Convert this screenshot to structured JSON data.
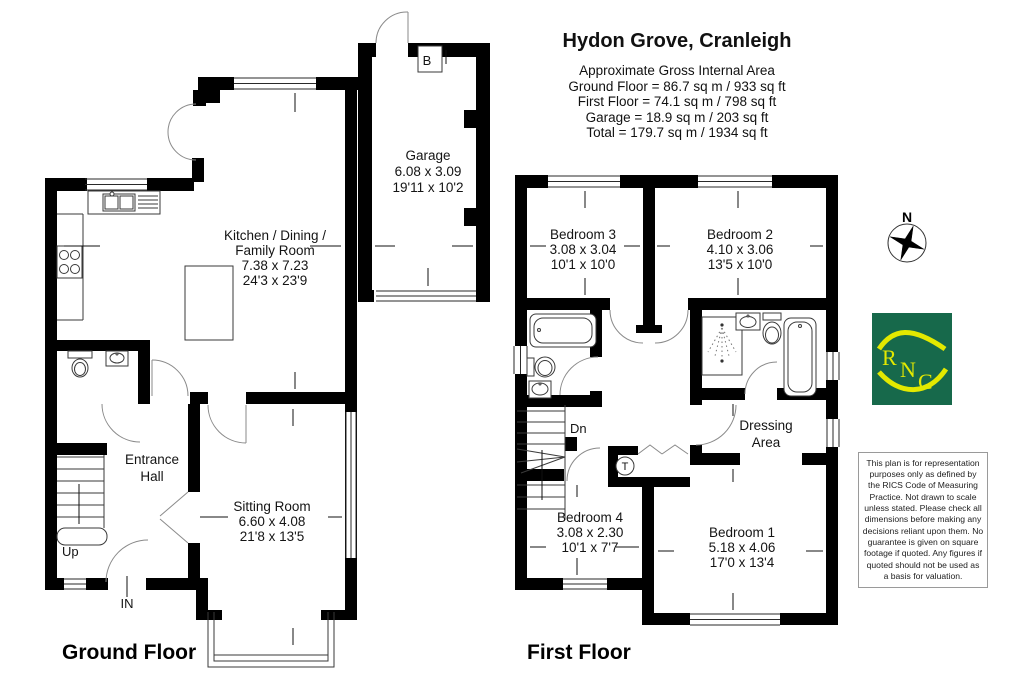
{
  "title_block": {
    "title": "Hydon Grove, Cranleigh",
    "area_lines": "Approximate Gross Internal Area\nGround Floor = 86.7 sq m / 933 sq ft\nFirst Floor = 74.1 sq m / 798 sq ft\nGarage = 18.9 sq m / 203 sq ft\nTotal = 179.7 sq m / 1934 sq ft"
  },
  "floors": {
    "ground": "Ground Floor",
    "first": "First Floor"
  },
  "rooms": {
    "kitchen": {
      "l1": "Kitchen / Dining /",
      "l2": "Family Room",
      "metric": "7.38 x 7.23",
      "imperial": "24'3 x 23'9"
    },
    "garage": {
      "name": "Garage",
      "metric": "6.08 x 3.09",
      "imperial": "19'11 x 10'2"
    },
    "sitting": {
      "name": "Sitting Room",
      "metric": "6.60 x 4.08",
      "imperial": "21'8 x 13'5"
    },
    "hall": {
      "l1": "Entrance",
      "l2": "Hall"
    },
    "bed1": {
      "name": "Bedroom 1",
      "metric": "5.18 x 4.06",
      "imperial": "17'0 x 13'4"
    },
    "bed2": {
      "name": "Bedroom 2",
      "metric": "4.10 x 3.06",
      "imperial": "13'5 x 10'0"
    },
    "bed3": {
      "name": "Bedroom 3",
      "metric": "3.08 x 3.04",
      "imperial": "10'1 x 10'0"
    },
    "bed4": {
      "name": "Bedroom 4",
      "metric": "3.08 x 2.30",
      "imperial": "10'1 x 7'7"
    },
    "dressing": {
      "l1": "Dressing",
      "l2": "Area"
    }
  },
  "markers": {
    "up": "Up",
    "down": "Dn",
    "entry": "IN",
    "boiler": "B",
    "tank": "T",
    "north": "N"
  },
  "logo": {
    "l0": "R",
    "l1": "N",
    "l2": "C",
    "bg": "#17694b",
    "fg": "#e3e900"
  },
  "disclaimer": "This plan is for representation\npurposes only as defined by\nthe RICS Code of Measuring\nPractice. Not drawn to scale\nunless stated. Please check all\ndimensions before making any\ndecisions reliant upon them. No\nguarantee is given on square\nfootage if quoted. Any figures if\nquoted should not be used as\na basis for valuation."
}
